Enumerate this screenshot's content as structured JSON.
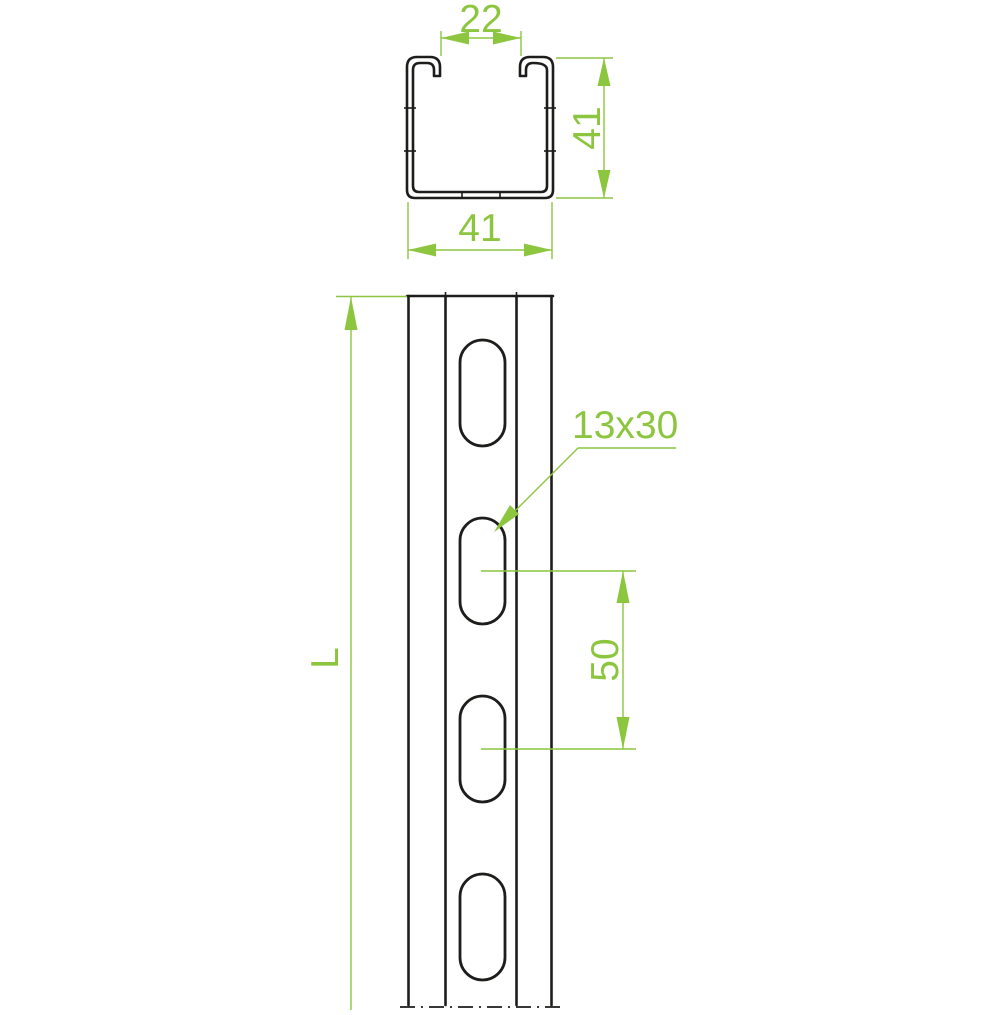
{
  "drawing": {
    "kind": "strut-channel-technical-drawing",
    "colors": {
      "accent_green": "#8CC63F",
      "outline_black": "#1d1d1b",
      "background": "#ffffff"
    },
    "cross_section_view": {
      "opening_width": "22",
      "section_height": "41",
      "section_width": "41"
    },
    "front_view": {
      "length_label": "L",
      "slot_size": "13x30",
      "slot_spacing": "50",
      "visible_slot_count": 4
    }
  }
}
